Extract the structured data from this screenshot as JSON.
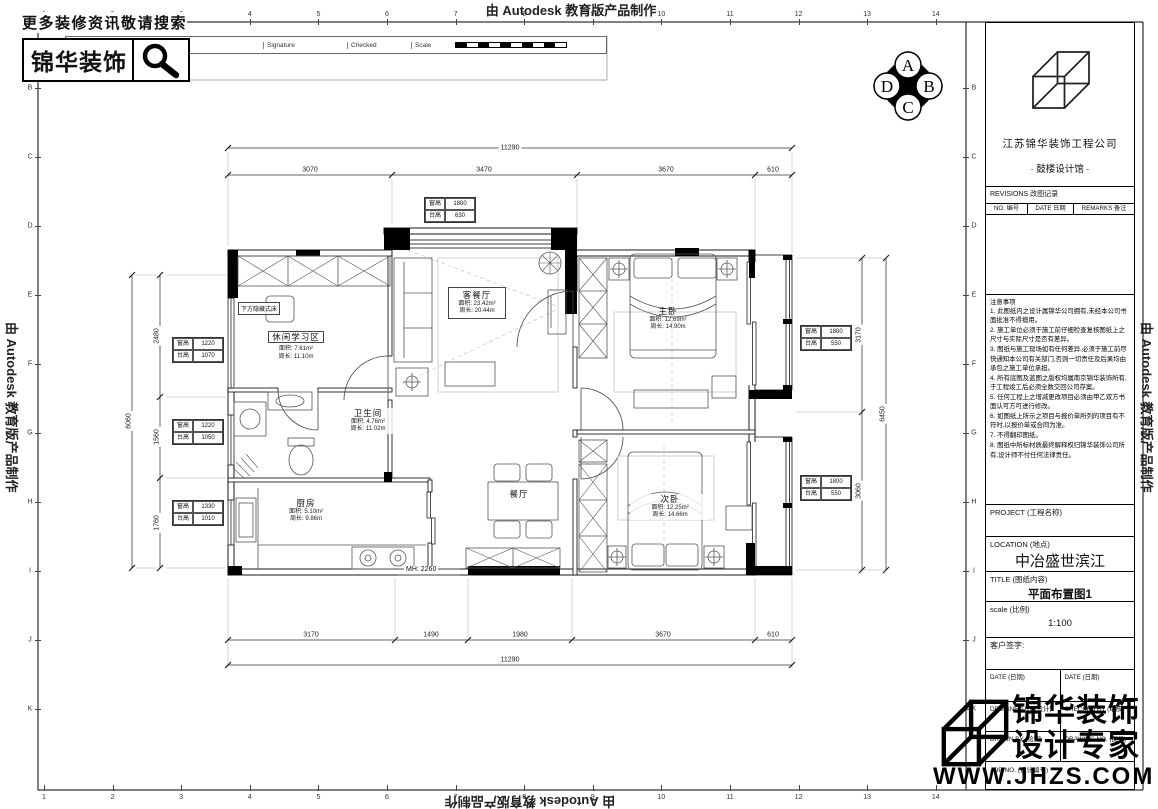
{
  "banner": {
    "autodesk": "由 Autodesk 教育版产品制作"
  },
  "header": {
    "tagline": "更多装修资讯敬请搜索",
    "brand": "锦华装饰",
    "strip": {
      "rev_no": "Rev No",
      "revision_note": "Revision note",
      "signature": "Signature",
      "checked": "Checked",
      "scale": "Scale"
    }
  },
  "elevation_marker": {
    "top": "A",
    "right": "B",
    "bottom": "C",
    "left": "D"
  },
  "grid": {
    "numbers": [
      "1",
      "2",
      "3",
      "4",
      "5",
      "6",
      "7",
      "8",
      "9",
      "10",
      "11",
      "12",
      "13",
      "14"
    ],
    "letters": [
      "B",
      "C",
      "D",
      "E",
      "F",
      "G",
      "H",
      "I",
      "J",
      "K"
    ]
  },
  "title_block": {
    "company": "江苏锦华装饰工程公司",
    "studio": "·    鼓楼设计馆    ·",
    "revisions": "REVISIONS 改图记录",
    "rev_cols": {
      "no": "NO. 编号",
      "date": "DATE 日期",
      "remarks": "REMARKS 备注"
    },
    "notes_title": "注意事项",
    "notes": [
      "1. 此图纸内之设计属锦华公司拥有,未经本公司书面批准不得擅用。",
      "2. 施工单位必须于施工前仔细检查复核图纸上之尺寸与实际尺寸是否有差异。",
      "3. 图纸与施工现场如有任何差异,必须于施工前尽快通知本公司有关部门,否则一切责任及后果均由承包之施工单位承担。",
      "4. 所有底图及蓝图之版权均属南京锦华装饰所有,于工程竣工后必须全数交回公司存案。",
      "5. 任何工程上之增减更改项目必须由甲乙双方书面认可方可进行修改。",
      "6. 如图纸上所示之项目与报价单所列的项目有不符时,以报价单或合同为准。",
      "7. 不得翻印图纸。",
      "8. 图纸中所标材质最终解释权归锦华装饰公司所有,设计师不付任何法律责任。"
    ],
    "project": "PROJECT (工程名称)",
    "location": "LOCATION (地点)",
    "location_value": "中冶盛世滨江",
    "title": "TITLE (图纸内容)",
    "title_value": "平面布置图1",
    "scale": "scale  (比例)",
    "scale_value": "1:100",
    "client_sign": "客户签字:",
    "date1": "DATE (日期)",
    "date2": "DATE (日期)",
    "designed": "DESIGNED BY (设计)",
    "checked": "CHECKED BY (审核)",
    "drawn": "DRAWN BY (绘图)",
    "drawing_no": "DRAWING NO. (图号)",
    "job_no": "JOB NO. (设计编号)"
  },
  "watermark": {
    "brand": "锦华装饰",
    "slogan": "设计专家",
    "site": "WWW.JHZS.COM"
  },
  "plan": {
    "rooms": {
      "living": {
        "name": "客餐厅",
        "area": "面积: 23.42m²",
        "perimeter": "周长: 20.44m"
      },
      "study": {
        "name": "休闲学习区",
        "area": "面积: 7.61m²",
        "perimeter": "周长: 11.10m"
      },
      "master": {
        "name": "主卧",
        "area": "面积: 12.69m²",
        "perimeter": "周长: 14.90m"
      },
      "bath": {
        "name": "卫生间",
        "area": "面积: 4.76m²",
        "perimeter": "周长: 11.02m"
      },
      "kitchen": {
        "name": "厨房",
        "area": "面积: 5.10m²",
        "perimeter": "周长: 9.86m"
      },
      "second": {
        "name": "次卧",
        "area": "面积: 12.25m²",
        "perimeter": "周长: 14.66m"
      },
      "dining": {
        "name": "餐厅"
      }
    },
    "annotations": {
      "hidden_bed": "下方隐藏式床",
      "door_height": "MH: 2260"
    },
    "dims": {
      "top_total": "11290",
      "top_segs": [
        "3070",
        "3470",
        "3670",
        "610"
      ],
      "bottom_segs": [
        "3170",
        "1490",
        "1980",
        "3670",
        "610"
      ],
      "bottom_total": "11290",
      "left_total": "6060",
      "left_segs": [
        "2480",
        "1560",
        "1760"
      ],
      "right_segs": [
        "3170",
        "3060"
      ],
      "right_total": "6450"
    },
    "window_tables": [
      {
        "l1": "窗高",
        "v1": "1800",
        "l2": "台高",
        "v2": "630"
      },
      {
        "l1": "窗高",
        "v1": "1220",
        "l2": "台高",
        "v2": "1070"
      },
      {
        "l1": "窗高",
        "v1": "1220",
        "l2": "台高",
        "v2": "1050"
      },
      {
        "l1": "窗高",
        "v1": "1330",
        "l2": "台高",
        "v2": "1010"
      },
      {
        "l1": "窗高",
        "v1": "1800",
        "l2": "台高",
        "v2": "550"
      },
      {
        "l1": "窗高",
        "v1": "1800",
        "l2": "台高",
        "v2": "550"
      }
    ]
  }
}
